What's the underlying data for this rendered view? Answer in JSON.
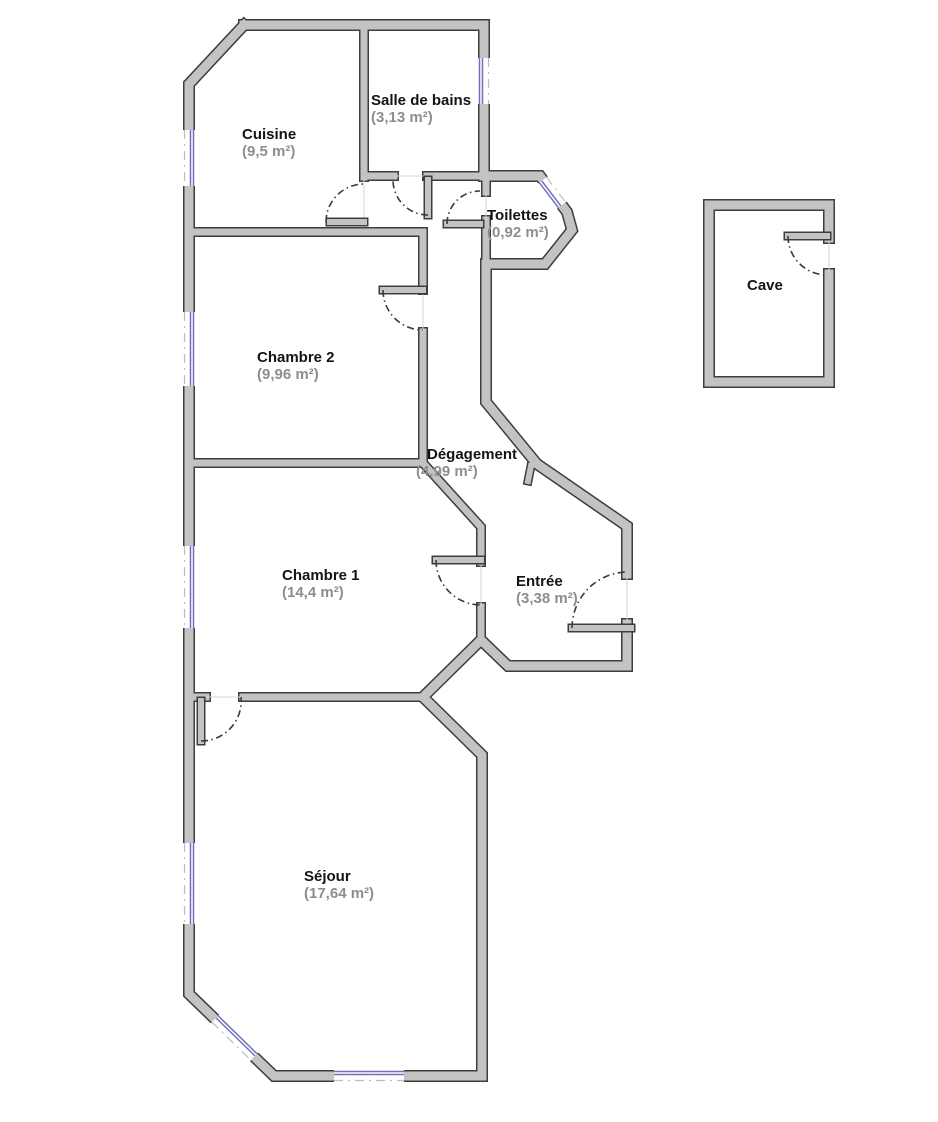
{
  "colors": {
    "wall-fill": "#c3c3c3",
    "wall-outline": "#3d3d3d",
    "window": "#6f6fc0",
    "window-dash": "#bdbdbd",
    "door-arc": "#3a3a3a",
    "floor-guide": "#d6d6d6",
    "room-name": "#141414",
    "room-area": "#8e8e8e",
    "page-bg": "#ffffff"
  },
  "rooms": [
    {
      "id": "cuisine",
      "name": "Cuisine",
      "area": "(9,5 m²)"
    },
    {
      "id": "salle-de-bains",
      "name": "Salle de bains",
      "area": "(3,13 m²)"
    },
    {
      "id": "toilettes",
      "name": "Toilettes",
      "area": "(0,92 m²)"
    },
    {
      "id": "chambre-2",
      "name": "Chambre 2",
      "area": "(9,96 m²)"
    },
    {
      "id": "degagement",
      "name": "Dégagement",
      "area": "(4,99 m²)"
    },
    {
      "id": "chambre-1",
      "name": "Chambre 1",
      "area": "(14,4 m²)"
    },
    {
      "id": "entree",
      "name": "Entrée",
      "area": "(3,38 m²)"
    },
    {
      "id": "sejour",
      "name": "Séjour",
      "area": "(17,64 m²)"
    },
    {
      "id": "cave",
      "name": "Cave",
      "area": ""
    }
  ]
}
